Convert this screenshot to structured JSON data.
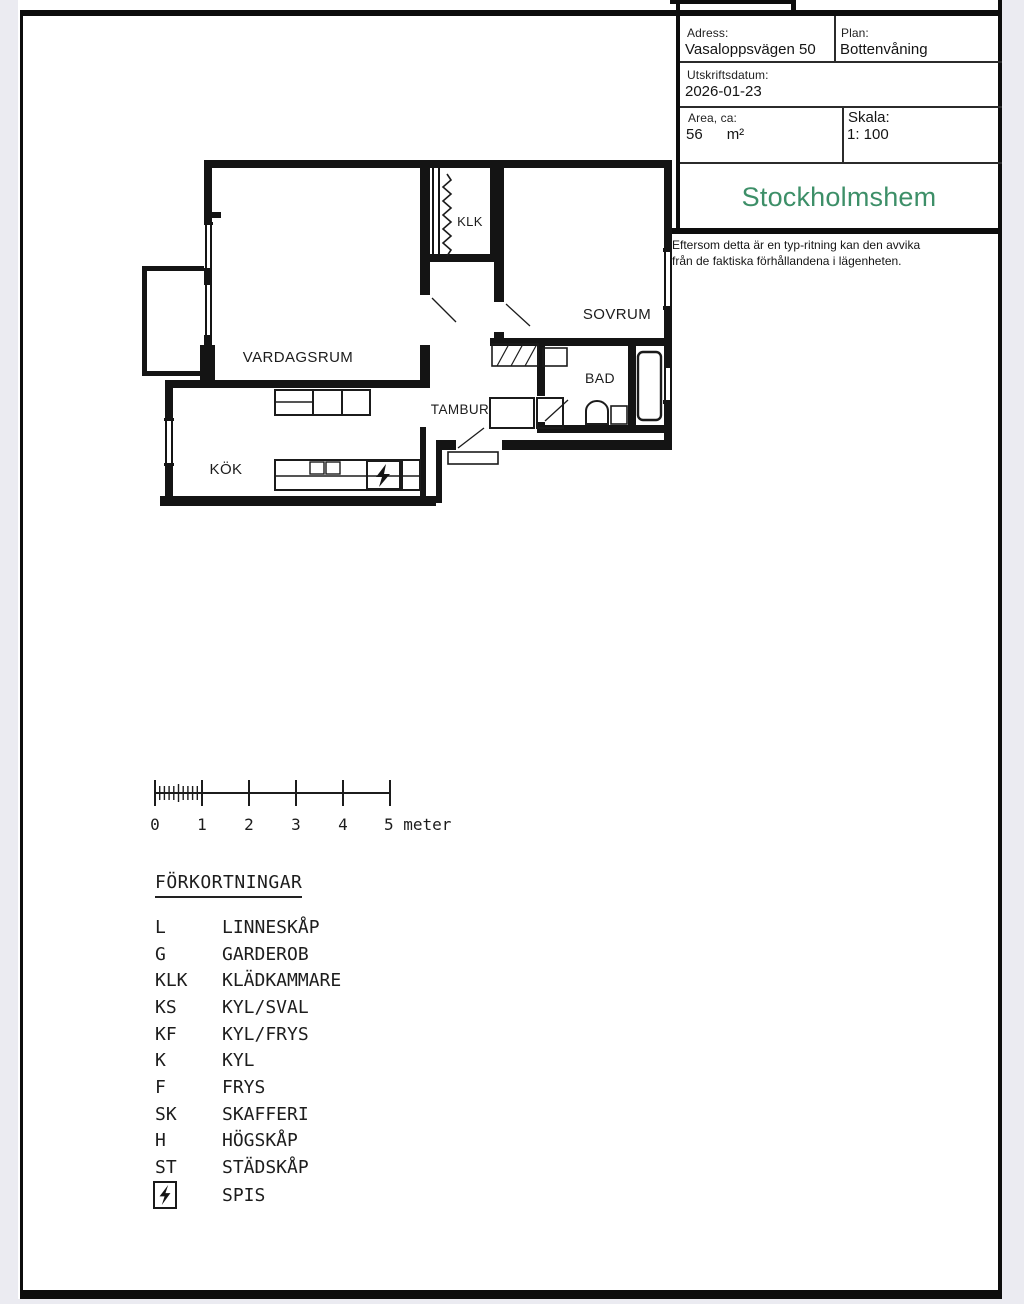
{
  "colors": {
    "viewer_background": "#ebebf1",
    "paper": "#ffffff",
    "ink": "#141414",
    "brand_green": "#3d8f68"
  },
  "info_panel": {
    "rows": [
      {
        "cells": [
          {
            "label": "Adress:",
            "value": "Vasaloppsvägen 50"
          },
          {
            "label": "Plan:",
            "value": "Bottenvåning"
          }
        ]
      },
      {
        "cells": [
          {
            "label": "Utskriftsdatum:",
            "value": "2026-01-23"
          }
        ]
      },
      {
        "cells": [
          {
            "label": "Area, ca:",
            "value": "56",
            "unit": "m²"
          },
          {
            "label": "Skala:",
            "value": "1: 100"
          }
        ]
      }
    ]
  },
  "brand": {
    "logo_text": "Stockholmshem"
  },
  "disclaimer": {
    "line1": "Eftersom detta är en typ-ritning kan den avvika",
    "line2": "från de faktiska förhållandena i lägenheten."
  },
  "floor_plan": {
    "rooms": [
      {
        "label": "VARDAGSRUM"
      },
      {
        "label": "KÖK"
      },
      {
        "label": "TAMBUR"
      },
      {
        "label": "SOVRUM"
      },
      {
        "label": "BAD"
      },
      {
        "label": "KLK"
      }
    ]
  },
  "scale_bar": {
    "labels": [
      "0",
      "1",
      "2",
      "3",
      "4"
    ],
    "end_label": "5 meter"
  },
  "legend": {
    "title": "FÖRKORTNINGAR",
    "items": [
      {
        "abbr": "L",
        "name": "LINNESKÅP"
      },
      {
        "abbr": "G",
        "name": "GARDEROB"
      },
      {
        "abbr": "KLK",
        "name": "KLÄDKAMMARE"
      },
      {
        "abbr": "KS",
        "name": "KYL/SVAL"
      },
      {
        "abbr": "KF",
        "name": "KYL/FRYS"
      },
      {
        "abbr": "K",
        "name": "KYL"
      },
      {
        "abbr": "F",
        "name": "FRYS"
      },
      {
        "abbr": "SK",
        "name": "SKAFFERI"
      },
      {
        "abbr": "H",
        "name": "HÖGSKÅP"
      },
      {
        "abbr": "ST",
        "name": "STÄDSKÅP"
      }
    ],
    "stove": {
      "name": "SPIS",
      "icon": "stove-lightning-icon"
    }
  }
}
